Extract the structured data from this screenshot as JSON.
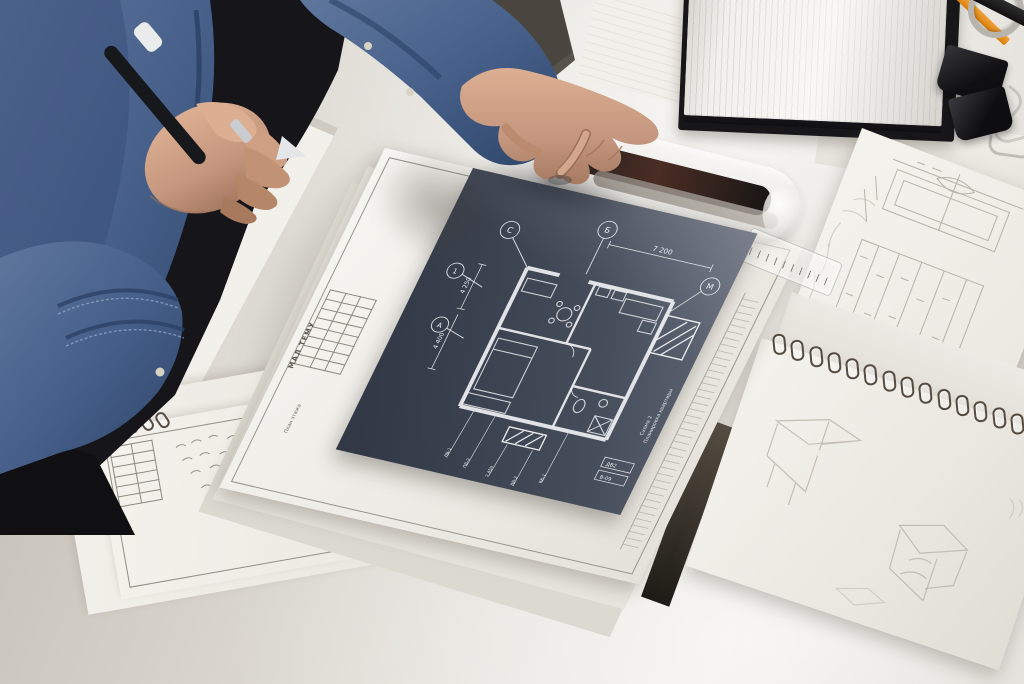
{
  "meta": {
    "scene": "overhead photo of an architect at a white desk reviewing a dark navy floor-plan print",
    "objects": [
      "denim-shirt-person",
      "left-hand-with-pen",
      "right-hand-pointing",
      "blueprint-print",
      "drawing-sheet-stack",
      "clear-marker-tube",
      "open-notebook",
      "orange-pencil",
      "binder-clips",
      "sketch-paper",
      "spiral-sketchbook",
      "spiral-notepad",
      "gray-pen"
    ]
  },
  "palette": {
    "desk": "#e7e4de",
    "blueprint_navy": "#3b4250",
    "blueprint_line": "#e9ebee",
    "denim": "#49618a",
    "skin": "#c99d85",
    "paper": "#f3f1ec",
    "pencil_orange": "#e08d14",
    "clip_black": "#1b1b1d"
  },
  "blueprint": {
    "grid_markers": {
      "c": "С",
      "b": "Б",
      "one": "1",
      "a": "А",
      "m": "М"
    },
    "dim_top": "7 200",
    "dim_left_upper": "4 250",
    "dim_left_lower": "4 400",
    "callouts": [
      "ДВ-1",
      "ПВ-2",
      "2 450",
      "ДВ-2",
      "ВК-1"
    ],
    "side_label_1": "Планировка квартиры",
    "side_label_2": "Схема 2",
    "legend_1": "ДВ2",
    "legend_2": "В-09"
  },
  "title_block": {
    "label": "МАЛ ТЕМУ",
    "row_text": "План этажа"
  }
}
